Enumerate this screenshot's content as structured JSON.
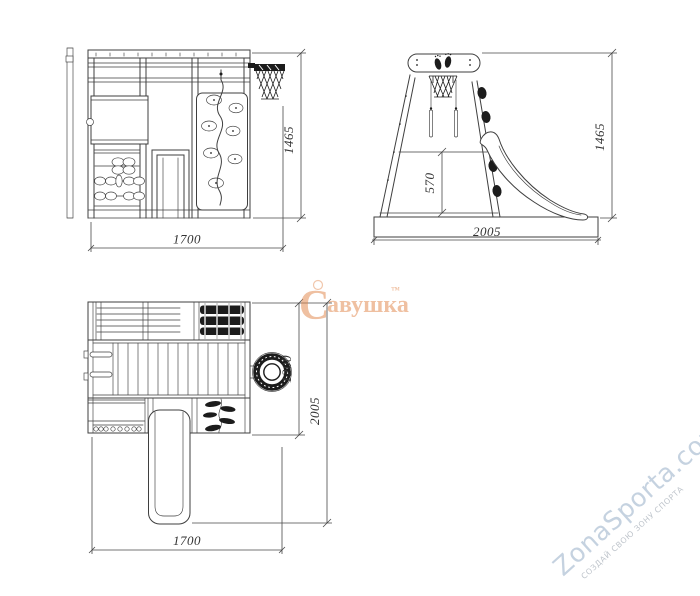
{
  "views": {
    "front": {
      "width_mm": "1700",
      "height_mm": "1465"
    },
    "side": {
      "length_mm": "2005",
      "height_mm": "1465",
      "deck_height_mm": "570"
    },
    "plan": {
      "width_mm": "1700",
      "length_mm": "2005",
      "body_depth_mm": "1200"
    }
  },
  "watermarks": {
    "savushka": {
      "initial": "С",
      "rest": "авушка",
      "trademark": "™",
      "color": "#e08246"
    },
    "zonasporta": {
      "site": "ZonaSporta.com",
      "slogan": "СОЗДАЙ СВОЮ ЗОНУ СПОРТА",
      "color": "#bccbdb"
    }
  },
  "colors": {
    "background": "#ffffff",
    "outline": "#3f3f3f",
    "dimension": "#4a4a4a",
    "dark_fill": "#1c1c1c"
  }
}
